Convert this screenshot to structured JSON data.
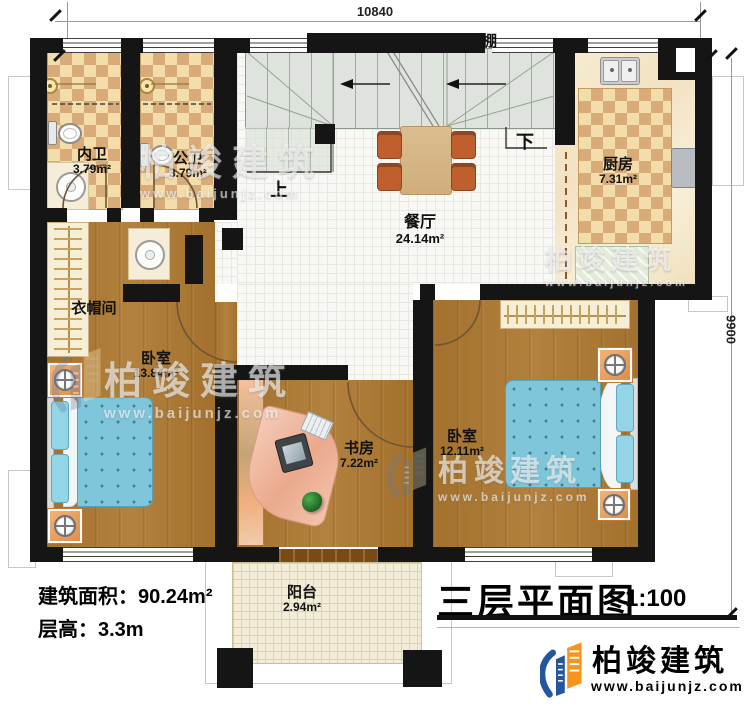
{
  "dimensions": {
    "top": "10840",
    "right": "9900"
  },
  "annotations": {
    "up": "上",
    "down": "下",
    "canopy": "棚"
  },
  "rooms": [
    {
      "name": "内卫",
      "area": "3.79m²"
    },
    {
      "name": "公卫",
      "area": "3.79m²"
    },
    {
      "name": "厨房",
      "area": "7.31m²"
    },
    {
      "name": "餐厅",
      "area": "24.14m²"
    },
    {
      "name": "衣帽间",
      "area": ""
    },
    {
      "name": "卧室",
      "area": "13.84m²"
    },
    {
      "name": "书房",
      "area": "7.22m²"
    },
    {
      "name": "卧室",
      "area": "12.11m²"
    },
    {
      "name": "阳台",
      "area": "2.94m²"
    }
  ],
  "info": {
    "area_label": "建筑面积：",
    "area_value": "90.24m²",
    "floor_label": "层高：",
    "floor_value": "3.3m"
  },
  "title_block": {
    "title": "三层平面图",
    "scale": "1:100"
  },
  "brand": {
    "name": "柏竣建筑",
    "url": "www.baijunjz.com"
  },
  "watermark": {
    "name": "柏竣建筑",
    "url": "www.baijunjz.com"
  },
  "colors": {
    "wall": "#151515",
    "wood": "#ad7830",
    "tile_light": "#f3ddab",
    "tile_dark": "#d8ab79",
    "stairs": "#dee4dd",
    "bed": "#7fc6db",
    "brand_blue": "#2456a0",
    "brand_orange": "#f7941d"
  }
}
